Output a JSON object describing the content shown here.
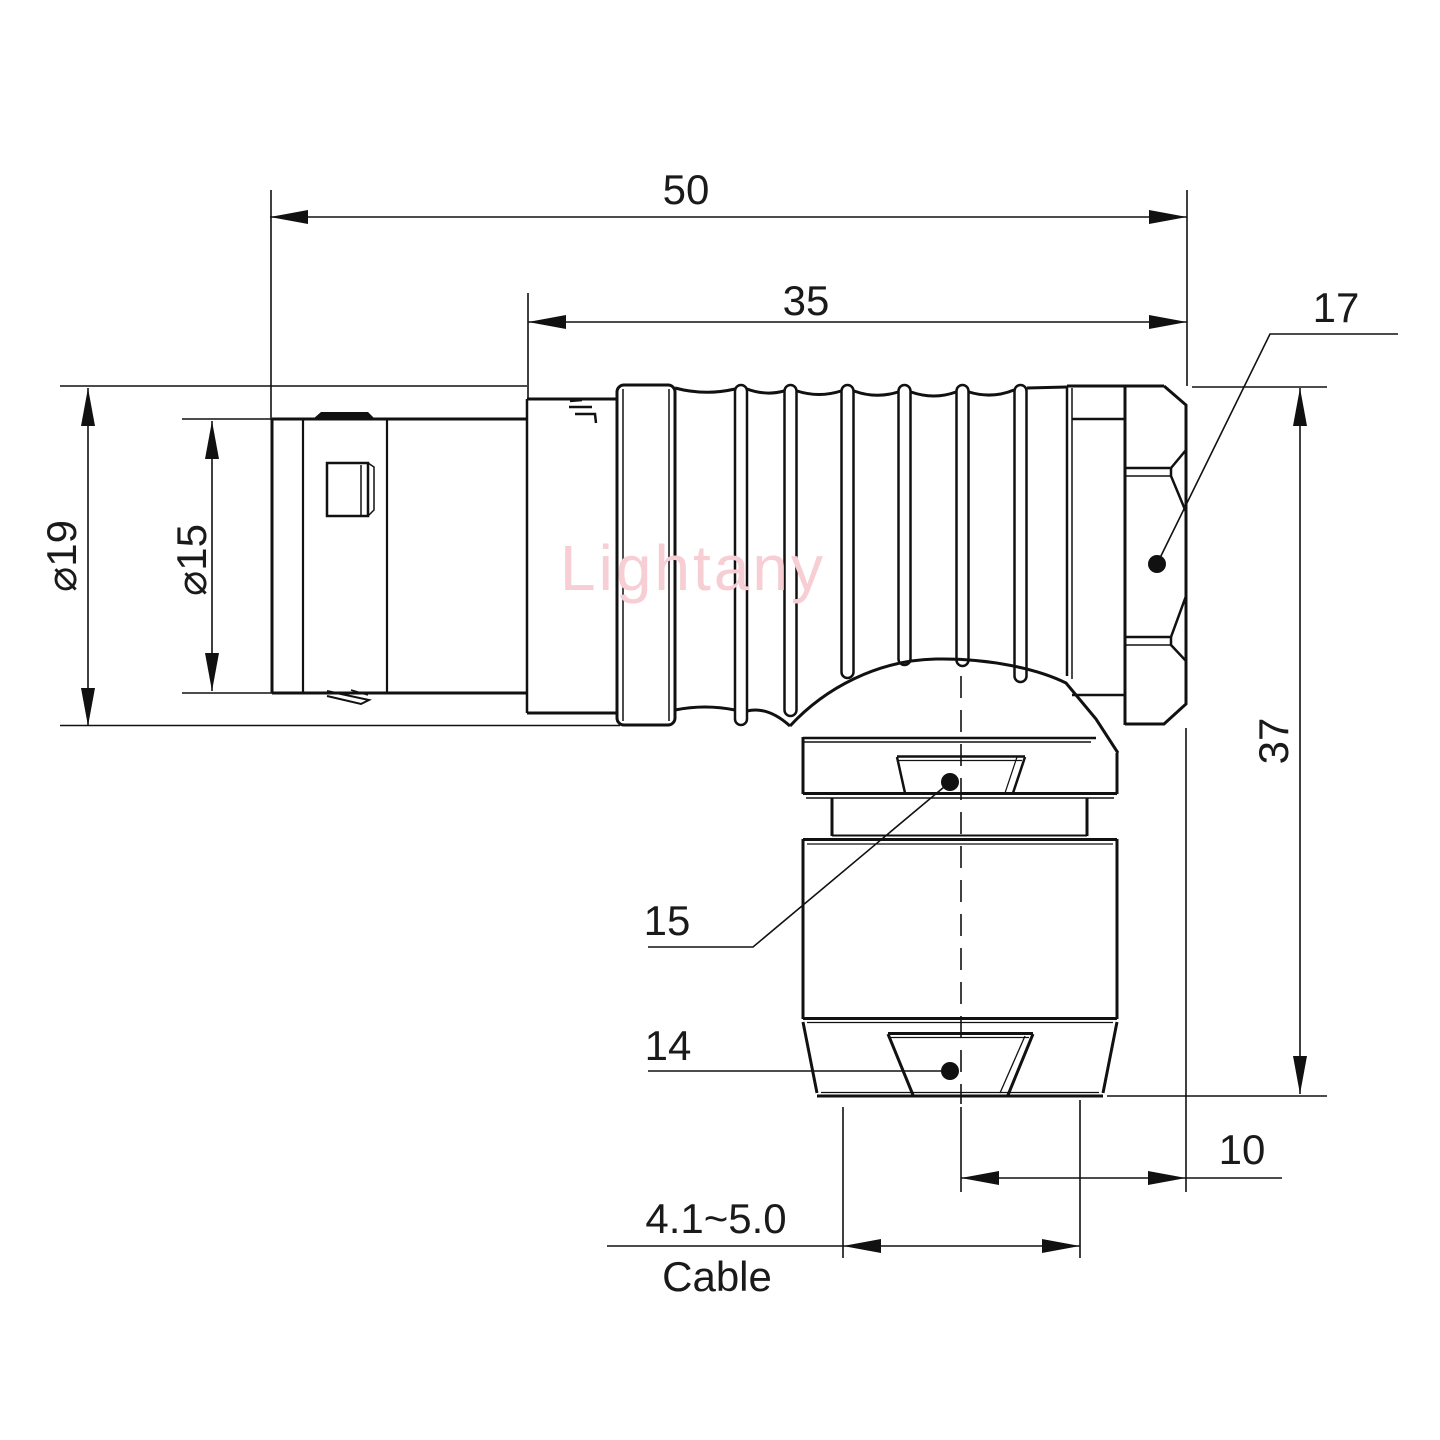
{
  "drawing": {
    "watermark": "Lightany",
    "dimensions": {
      "overall_length": "50",
      "body_length": "35",
      "hex_flat": "17",
      "outer_diameter": "⌀19",
      "front_diameter": "⌀15",
      "overall_height": "37",
      "collar_flat": "15",
      "cap_flat": "14",
      "exit_offset": "10",
      "cable_range": "4.1~5.0",
      "cable_label": "Cable"
    }
  }
}
